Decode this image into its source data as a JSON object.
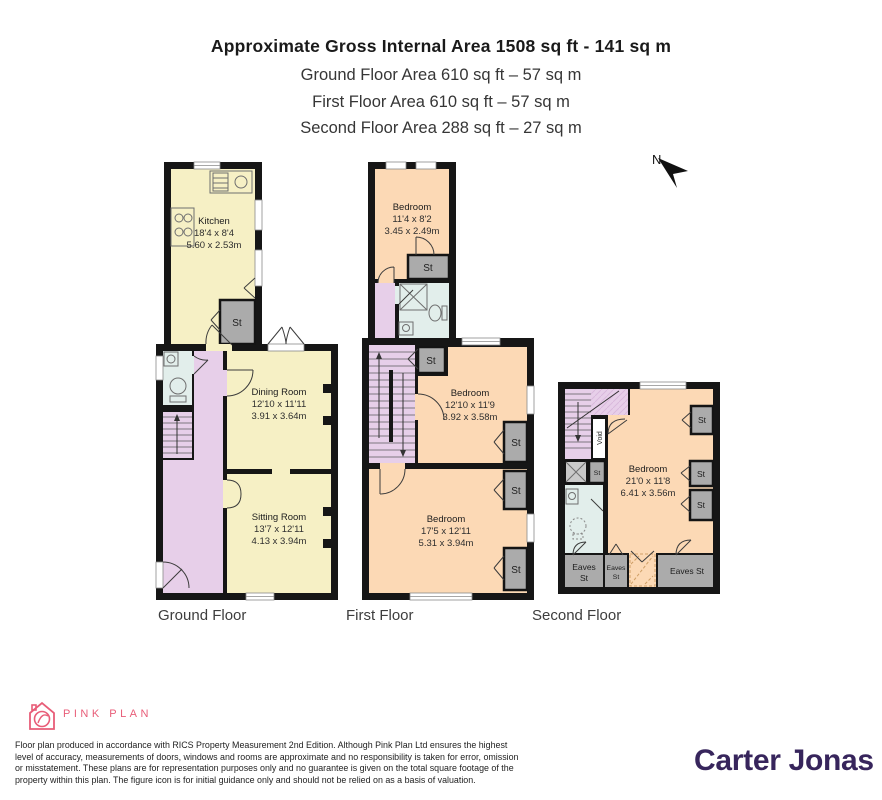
{
  "header": {
    "title": "Approximate Gross Internal Area 1508 sq ft - 141 sq m",
    "subtitles": [
      "Ground Floor Area 610 sq ft – 57 sq m",
      "First Floor Area 610 sq ft – 57 sq m",
      "Second Floor Area 288 sq ft – 27 sq m"
    ]
  },
  "compass": {
    "label": "N"
  },
  "floors": {
    "ground": {
      "label": "Ground Floor",
      "rooms": {
        "kitchen": {
          "name": "Kitchen",
          "imperial": "18'4 x 8'4",
          "metric": "5.60 x 2.53m"
        },
        "dining": {
          "name": "Dining Room",
          "imperial": "12'10 x 11'11",
          "metric": "3.91 x 3.64m"
        },
        "sitting": {
          "name": "Sitting Room",
          "imperial": "13'7 x 12'11",
          "metric": "4.13 x 3.94m"
        },
        "st": "St"
      }
    },
    "first": {
      "label": "First Floor",
      "rooms": {
        "bedroom1": {
          "name": "Bedroom",
          "imperial": "11'4 x 8'2",
          "metric": "3.45 x 2.49m"
        },
        "bedroom2": {
          "name": "Bedroom",
          "imperial": "12'10 x 11'9",
          "metric": "3.92 x 3.58m"
        },
        "bedroom3": {
          "name": "Bedroom",
          "imperial": "17'5 x 12'11",
          "metric": "5.31 x 3.94m"
        },
        "st": "St"
      }
    },
    "second": {
      "label": "Second Floor",
      "rooms": {
        "bedroom": {
          "name": "Bedroom",
          "imperial": "21'0 x 11'8",
          "metric": "6.41 x 3.56m"
        },
        "void": "Void",
        "st": "St",
        "eaves": "Eaves",
        "eaves_st": "Eaves St"
      }
    }
  },
  "branding": {
    "pink_plan": "PINK PLAN",
    "carter_jonas": "Carter Jonas"
  },
  "disclaimer": {
    "lines": [
      "Floor plan produced in accordance with RICS Property Measurement 2nd Edition. Although Pink Plan Ltd ensures the highest",
      "level of accuracy, measurements of doors, windows and rooms are approximate and no responsibility is taken for error, omission",
      "or misstatement. These plans are for representation purposes only and no guarantee is given on the total square footage of the",
      "property within this plan. The figure icon is for initial guidance only and should not be relied on as a basis of valuation."
    ]
  },
  "colors": {
    "wall": "#161616",
    "ground_room": "#f6f0c5",
    "bedroom": "#fcd9b5",
    "hall_stairs": "#e7cfe9",
    "bathroom": "#e2eeeb",
    "storage": "#ababab",
    "brand_pink": "#e85d78",
    "brand_purple": "#37255c"
  }
}
